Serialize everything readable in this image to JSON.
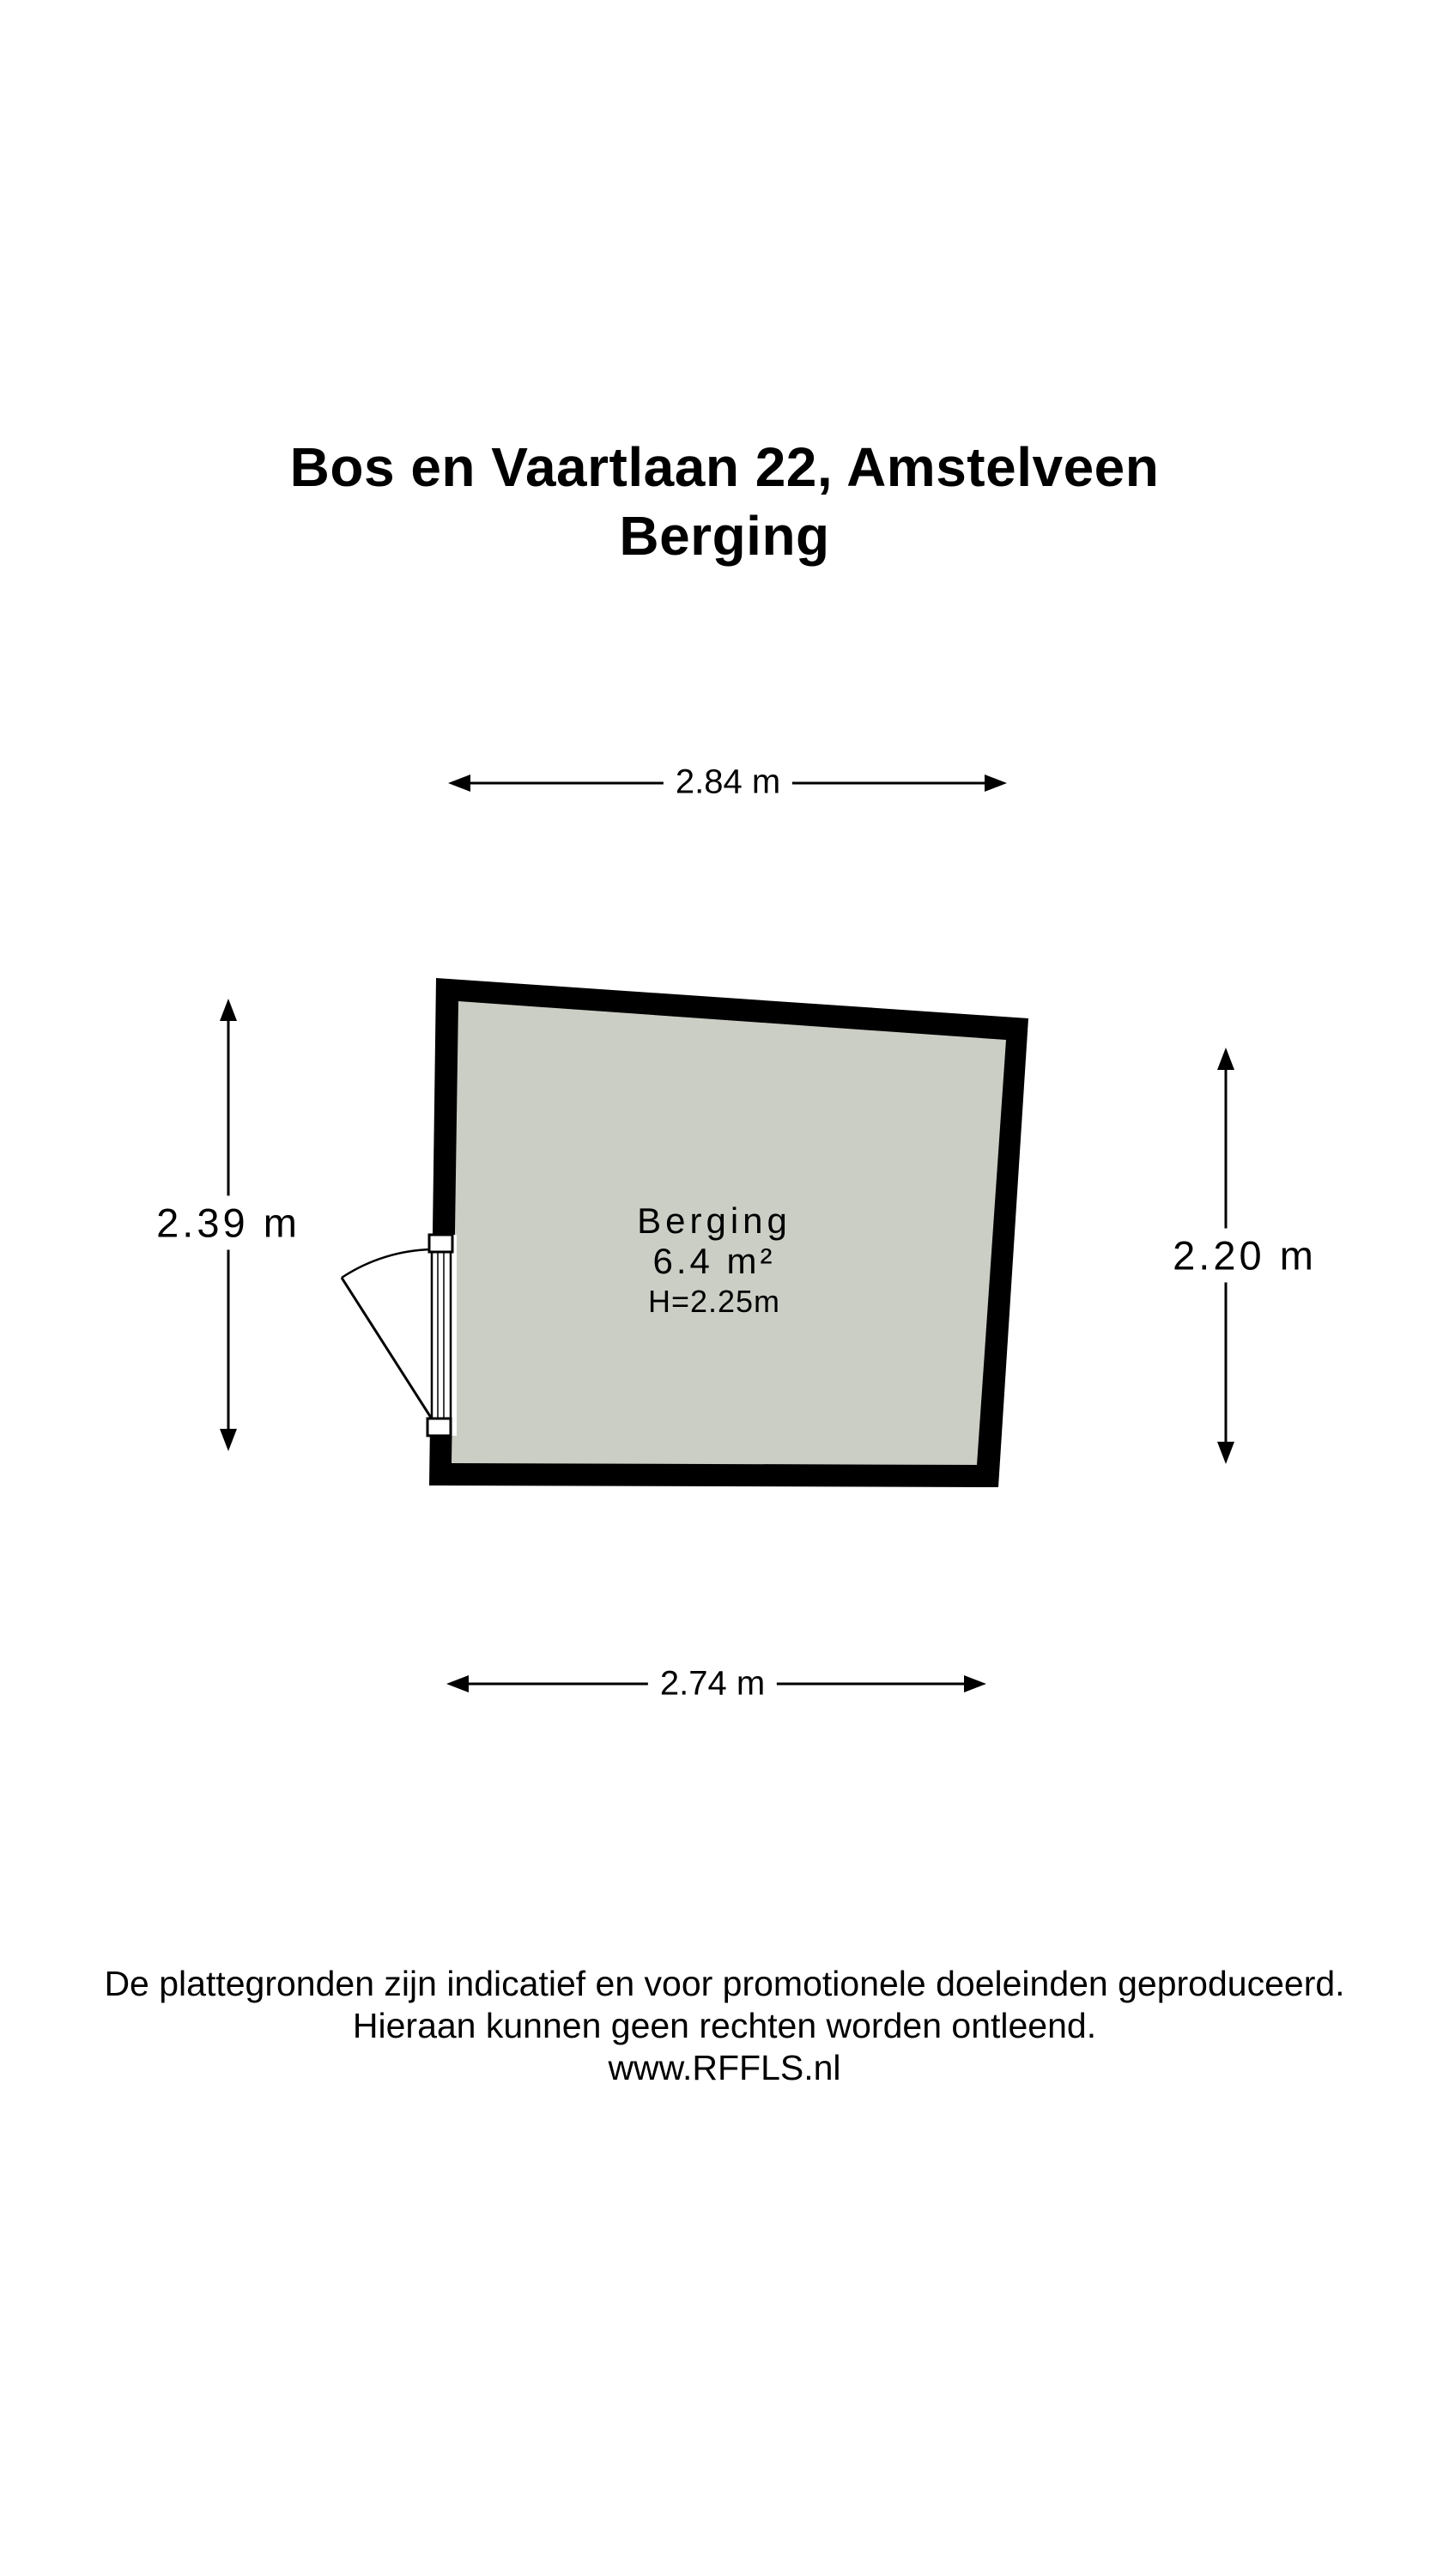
{
  "title": {
    "line1": "Bos en Vaartlaan 22, Amstelveen",
    "line2": "Berging"
  },
  "dimensions": {
    "top": "2.84 m",
    "left": "2.39 m",
    "right": "2.20 m",
    "bottom": "2.74 m"
  },
  "room": {
    "name": "Berging",
    "area": "6.4 m²",
    "ceiling_height": "H=2.25m"
  },
  "footer": {
    "line1": "De plattegronden zijn indicatief en voor promotionele doeleinden geproduceerd.",
    "line2": "Hieraan kunnen geen rechten worden ontleend.",
    "line3": "www.RFFLS.nl"
  },
  "colors": {
    "wall": "#000000",
    "floor": "#cbcec5",
    "line": "#000000",
    "background": "#ffffff"
  }
}
